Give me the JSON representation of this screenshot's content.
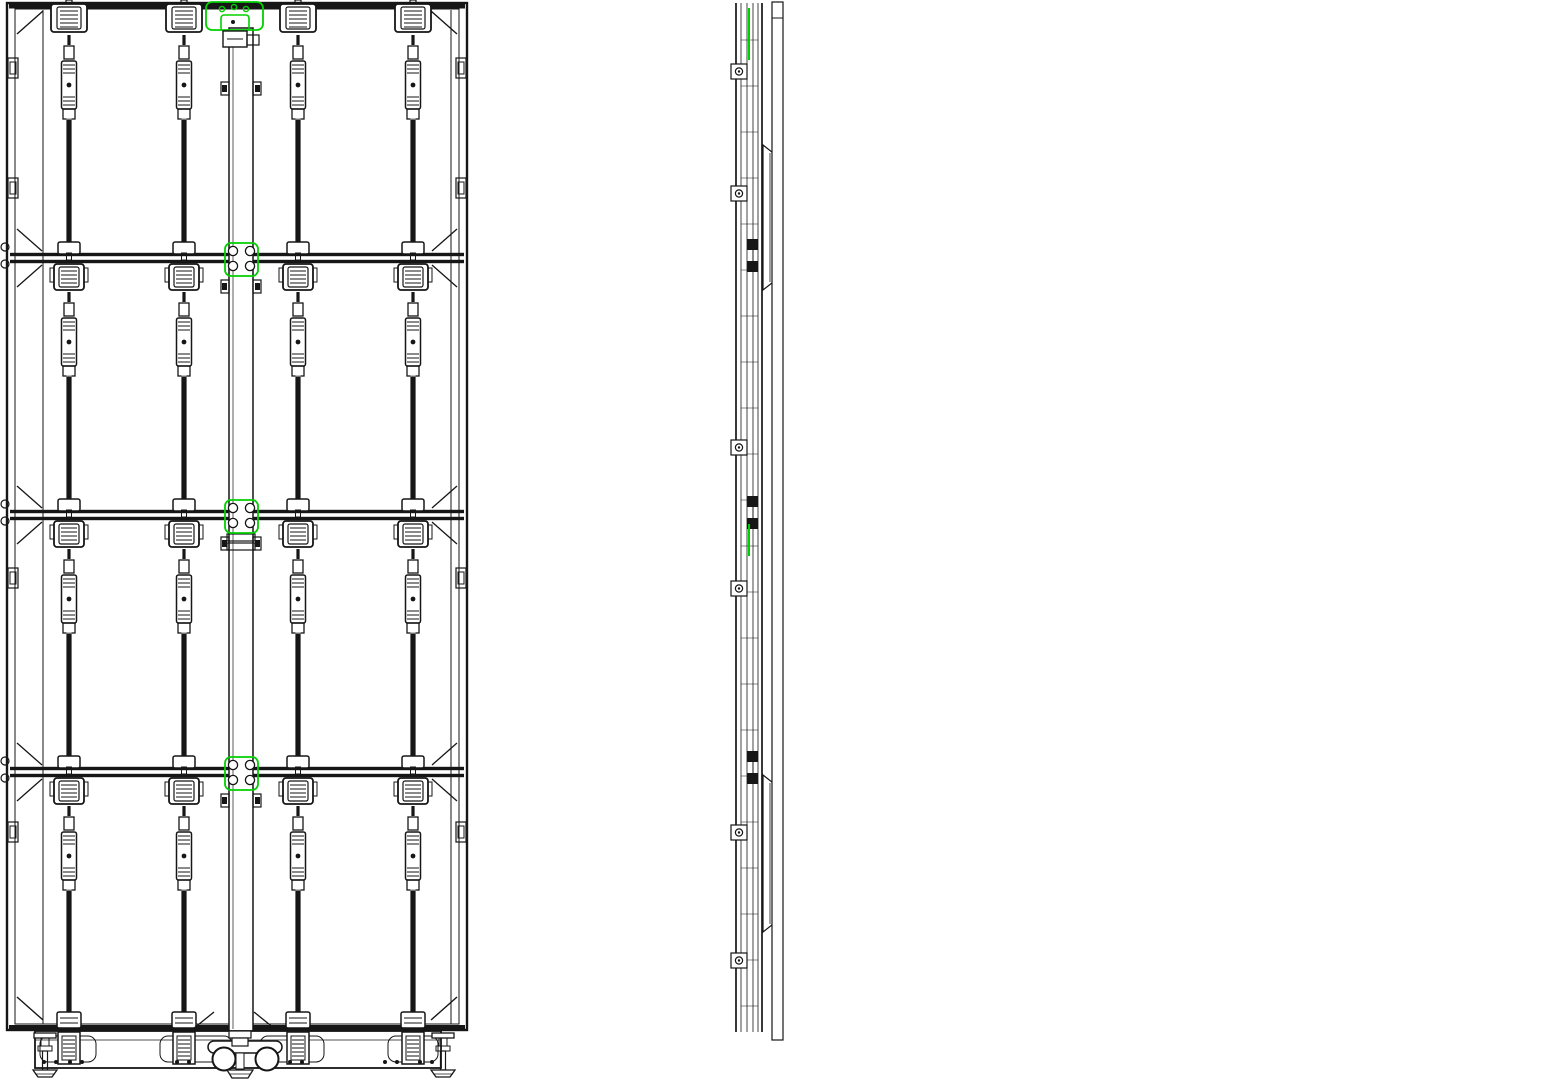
{
  "colors": {
    "ink": "#161616",
    "green": "#00d000",
    "red": "#f04537",
    "orange": "#f0821e",
    "paper": "#ffffff"
  },
  "front": {
    "frame": {
      "x": 7,
      "y": 3,
      "w": 460,
      "h": 1027,
      "inner_left_x": 43,
      "inner_right_x": 451
    },
    "latch_columns": [
      69,
      184,
      298,
      413
    ],
    "seams": [
      258,
      515,
      772
    ],
    "row_tops": [
      3,
      258,
      515,
      772
    ],
    "bottom_plate_y": 1012,
    "edge_clip_ys": [
      58,
      178,
      568,
      822
    ],
    "pole": {
      "x": 229,
      "y": 28,
      "w": 24,
      "h": 1004,
      "coupler_y": 534,
      "tab_ys": [
        82,
        280,
        537,
        794
      ]
    },
    "base": {
      "x": 35,
      "y": 1031,
      "w": 406,
      "h": 37,
      "slots": [
        [
          40,
          56
        ],
        [
          160,
          72
        ],
        [
          260,
          64
        ],
        [
          388,
          50
        ]
      ],
      "block_xs": [
        69,
        184,
        298,
        413
      ],
      "foot_xs": [
        45,
        443
      ],
      "wheel_xs": [
        224,
        267
      ],
      "wheel_y": 1059,
      "wheel_r": 11.5,
      "dot_xs": [
        44,
        56,
        70,
        82,
        177,
        189,
        290,
        302,
        385,
        397,
        420,
        432
      ],
      "dot_y": 1062
    }
  },
  "side": {
    "col_xs": [
      736,
      741,
      747,
      753,
      758,
      762
    ],
    "bolt_ys": [
      64,
      186,
      440,
      581,
      825,
      953
    ],
    "bracket_spans": [
      [
        145,
        290
      ],
      [
        775,
        932
      ]
    ],
    "arm_ys": [
      29,
      285,
      542,
      797
    ],
    "arm_square_ys": [
      285,
      542,
      797
    ],
    "green_spans": [
      [
        8,
        60
      ],
      [
        524,
        556
      ]
    ],
    "front_rail": {
      "x": 772,
      "w": 11,
      "y": 2,
      "h": 1038
    },
    "rear_rail": {
      "x": 857,
      "w": 15,
      "y": 23,
      "h": 1017
    },
    "rung_ys": [
      67,
      196,
      325,
      454,
      583,
      712,
      841,
      970
    ],
    "joint_y": 737,
    "sleeve_y": 538,
    "base_block": {
      "x": 718,
      "y": 1012,
      "w": 36,
      "h": 56
    },
    "red_beam": {
      "x": 755,
      "y": 1049,
      "w": 285,
      "h": 14,
      "bolt_xs": [
        788,
        846
      ]
    },
    "red_screw_x": 1022,
    "marker": {
      "x": 692,
      "y": 1010
    }
  },
  "iso": {
    "quad": {
      "tl": [
        1163,
        297
      ],
      "tr": [
        1426,
        33
      ],
      "br": [
        1426,
        905
      ],
      "bl": [
        1163,
        1013
      ]
    },
    "seam_ts": [
      0.25,
      0.5,
      0.75
    ],
    "mullion_xs": [
      1196,
      1266,
      1300,
      1360
    ],
    "handles": {
      "1196": [
        320,
        505,
        690,
        868
      ],
      "1266": [
        252,
        440,
        622,
        806
      ],
      "1360": [
        140,
        345,
        553,
        760
      ]
    },
    "edge_knob_ys": [
      133,
      219,
      350,
      437,
      568,
      655,
      786,
      872
    ],
    "pole": {
      "x": 1317,
      "w": 22,
      "y": 196,
      "h": 710,
      "ring_ys": [
        212,
        386,
        560,
        734
      ]
    },
    "green_bracket_ys": [
      516,
      690
    ],
    "ladder": {
      "rail_x": 1394,
      "rail_w": 14,
      "rail_y": 232,
      "rail_h": 726,
      "sleeve_y": 530,
      "rung_ys": [
        240,
        345,
        450,
        553,
        658,
        763,
        860
      ],
      "rung_dx": 64,
      "rung_drop": 22,
      "rung_t": 12
    },
    "strut": [
      [
        1188,
        866
      ],
      [
        1332,
        950
      ]
    ],
    "base": {
      "end_block": [
        1150,
        1002,
        40,
        54
      ],
      "top": [
        [
          1152,
          1005
        ],
        [
          1298,
          912
        ],
        [
          1318,
          923
        ],
        [
          1172,
          1017
        ]
      ],
      "front": [
        [
          1172,
          1017
        ],
        [
          1318,
          923
        ],
        [
          1318,
          944
        ],
        [
          1172,
          1040
        ]
      ]
    },
    "red": {
      "tube1": [
        [
          1292,
          925
        ],
        [
          1552,
          1005
        ],
        [
          1286,
          937
        ],
        [
          1552,
          1022
        ]
      ],
      "tube2": [
        [
          1280,
          947
        ],
        [
          1520,
          1036
        ],
        [
          1274,
          958
        ],
        [
          1514,
          1051
        ]
      ],
      "bolts": [
        [
          1317,
          936
        ],
        [
          1362,
          958
        ]
      ],
      "hex_c": [
        1536,
        1012
      ],
      "pad_c": [
        1538,
        1040
      ]
    }
  }
}
